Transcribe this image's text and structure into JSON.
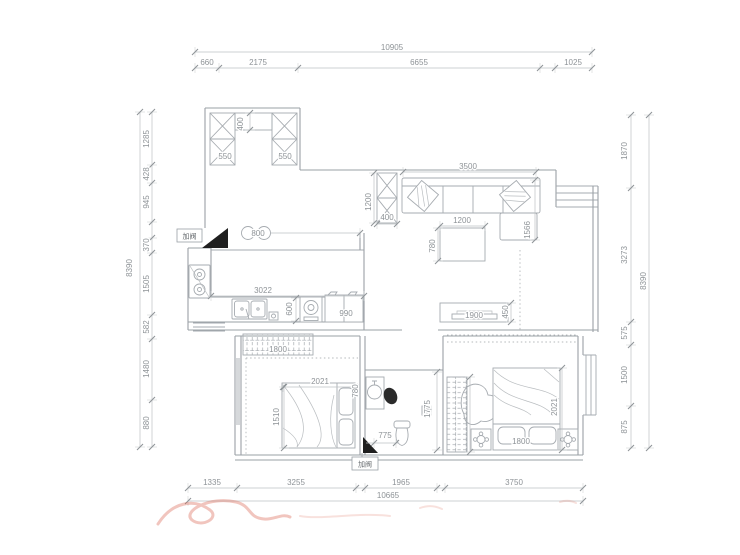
{
  "document": {
    "type": "residential-floor-plan"
  },
  "colors": {
    "background": "#ffffff",
    "line": "#9aa0a6",
    "dim_text": "#8e9397",
    "black_marker": "#1f1f1f",
    "watermark": "#d85a45"
  },
  "annotations": {
    "valve_top": "加阀",
    "valve_bottom": "加阀"
  },
  "dimension_labels": [
    {
      "t": "10905",
      "x": 392,
      "y": 50
    },
    {
      "t": "660",
      "x": 207,
      "y": 65
    },
    {
      "t": "2175",
      "x": 258,
      "y": 65
    },
    {
      "t": "6655",
      "x": 419,
      "y": 65
    },
    {
      "t": "1025",
      "x": 573,
      "y": 65
    },
    {
      "t": "8390",
      "x": 132,
      "y": 268,
      "r": -90
    },
    {
      "t": "1285",
      "x": 149,
      "y": 139,
      "r": -90
    },
    {
      "t": "428",
      "x": 149,
      "y": 174,
      "r": -90
    },
    {
      "t": "945",
      "x": 149,
      "y": 202,
      "r": -90
    },
    {
      "t": "370",
      "x": 149,
      "y": 245,
      "r": -90
    },
    {
      "t": "1505",
      "x": 149,
      "y": 284,
      "r": -90
    },
    {
      "t": "582",
      "x": 149,
      "y": 327,
      "r": -90
    },
    {
      "t": "1480",
      "x": 149,
      "y": 369,
      "r": -90
    },
    {
      "t": "880",
      "x": 149,
      "y": 423,
      "r": -90
    },
    {
      "t": "1870",
      "x": 627,
      "y": 151,
      "r": -90
    },
    {
      "t": "3273",
      "x": 627,
      "y": 255,
      "r": -90
    },
    {
      "t": "575",
      "x": 627,
      "y": 333,
      "r": -90
    },
    {
      "t": "1500",
      "x": 627,
      "y": 375,
      "r": -90
    },
    {
      "t": "875",
      "x": 627,
      "y": 427,
      "r": -90
    },
    {
      "t": "8390",
      "x": 646,
      "y": 281,
      "r": -90
    },
    {
      "t": "1335",
      "x": 212,
      "y": 485
    },
    {
      "t": "3255",
      "x": 296,
      "y": 485
    },
    {
      "t": "1965",
      "x": 401,
      "y": 485
    },
    {
      "t": "3750",
      "x": 514,
      "y": 485
    },
    {
      "t": "10665",
      "x": 388,
      "y": 498
    },
    {
      "t": "3500",
      "x": 468,
      "y": 169
    },
    {
      "t": "400",
      "x": 243,
      "y": 124,
      "r": -90
    },
    {
      "t": "550",
      "x": 225,
      "y": 159
    },
    {
      "t": "550",
      "x": 285,
      "y": 159
    },
    {
      "t": "800",
      "x": 258,
      "y": 236
    },
    {
      "t": "3022",
      "x": 263,
      "y": 293
    },
    {
      "t": "600",
      "x": 292,
      "y": 309,
      "r": -90
    },
    {
      "t": "990",
      "x": 346,
      "y": 316
    },
    {
      "t": "1200",
      "x": 371,
      "y": 202,
      "r": -90
    },
    {
      "t": "400",
      "x": 387,
      "y": 220
    },
    {
      "t": "1200",
      "x": 462,
      "y": 223
    },
    {
      "t": "780",
      "x": 435,
      "y": 246,
      "r": -90
    },
    {
      "t": "1566",
      "x": 530,
      "y": 230,
      "r": -90
    },
    {
      "t": "1900",
      "x": 474,
      "y": 318
    },
    {
      "t": "450",
      "x": 508,
      "y": 312,
      "r": -90
    },
    {
      "t": "1800",
      "x": 278,
      "y": 352
    },
    {
      "t": "2021",
      "x": 320,
      "y": 384
    },
    {
      "t": "1510",
      "x": 279,
      "y": 417,
      "r": -90
    },
    {
      "t": "780",
      "x": 358,
      "y": 391,
      "r": -90
    },
    {
      "t": "775",
      "x": 385,
      "y": 438
    },
    {
      "t": "1775",
      "x": 430,
      "y": 409,
      "r": -90
    },
    {
      "t": "2021",
      "x": 557,
      "y": 407,
      "r": -90
    },
    {
      "t": "1800",
      "x": 521,
      "y": 444
    }
  ],
  "dimension_chains": [
    {
      "o": "h",
      "pos": 52,
      "a": 195,
      "b": 592,
      "ticks": [
        195,
        592
      ]
    },
    {
      "o": "h",
      "pos": 68,
      "a": 195,
      "b": 592,
      "ticks": [
        195,
        219,
        298,
        540,
        555,
        592
      ]
    },
    {
      "o": "v",
      "pos": 140,
      "a": 112,
      "b": 447,
      "ticks": [
        112,
        447
      ]
    },
    {
      "o": "v",
      "pos": 152,
      "a": 112,
      "b": 447,
      "ticks": [
        112,
        165,
        183,
        222,
        238,
        253,
        315,
        339,
        400,
        447
      ]
    },
    {
      "o": "v",
      "pos": 631,
      "a": 115,
      "b": 448,
      "ticks": [
        115,
        188,
        322,
        345,
        406,
        448
      ]
    },
    {
      "o": "v",
      "pos": 649,
      "a": 115,
      "b": 448,
      "ticks": [
        115,
        448
      ]
    },
    {
      "o": "h",
      "pos": 488,
      "a": 188,
      "b": 583,
      "ticks": [
        188,
        237,
        356,
        365,
        437,
        445,
        583
      ]
    },
    {
      "o": "h",
      "pos": 501,
      "a": 188,
      "b": 583,
      "ticks": [
        188,
        583
      ]
    },
    {
      "o": "h",
      "pos": 172,
      "a": 403,
      "b": 536,
      "ticks": [
        403,
        536
      ]
    },
    {
      "o": "v",
      "pos": 250,
      "a": 113,
      "b": 130,
      "ticks": [
        113,
        130
      ]
    },
    {
      "o": "h",
      "pos": 296,
      "a": 211,
      "b": 364,
      "ticks": [
        211,
        364
      ]
    },
    {
      "o": "v",
      "pos": 296,
      "a": 298,
      "b": 321,
      "ticks": [
        298,
        321
      ]
    },
    {
      "o": "h",
      "pos": 233,
      "a": 271,
      "b": 360,
      "ticks": [
        360
      ]
    },
    {
      "o": "v",
      "pos": 374,
      "a": 173,
      "b": 223,
      "ticks": [
        173,
        223
      ]
    },
    {
      "o": "h",
      "pos": 224,
      "a": 377,
      "b": 397,
      "ticks": [
        377,
        397
      ]
    },
    {
      "o": "h",
      "pos": 226,
      "a": 440,
      "b": 485,
      "ticks": [
        440,
        485
      ]
    },
    {
      "o": "v",
      "pos": 438,
      "a": 228,
      "b": 261,
      "ticks": [
        228,
        261
      ]
    },
    {
      "o": "v",
      "pos": 535,
      "a": 180,
      "b": 240,
      "ticks": [
        180,
        240
      ]
    },
    {
      "o": "v",
      "pos": 511,
      "a": 303,
      "b": 322,
      "ticks": [
        303,
        322
      ]
    },
    {
      "o": "h",
      "pos": 387,
      "a": 283,
      "b": 355,
      "ticks": [
        283,
        355
      ]
    },
    {
      "o": "v",
      "pos": 284,
      "a": 387,
      "b": 448,
      "ticks": [
        387,
        448
      ]
    },
    {
      "o": "h",
      "pos": 443,
      "a": 366,
      "b": 399,
      "ticks": [
        374,
        396
      ]
    },
    {
      "o": "v",
      "pos": 437,
      "a": 372,
      "b": 450,
      "ticks": [
        372,
        450
      ]
    },
    {
      "o": "v",
      "pos": 562,
      "a": 368,
      "b": 450,
      "ticks": [
        368,
        450
      ]
    },
    {
      "o": "v",
      "pos": 470,
      "a": 377,
      "b": 452,
      "ticks": [
        377,
        452
      ]
    }
  ]
}
